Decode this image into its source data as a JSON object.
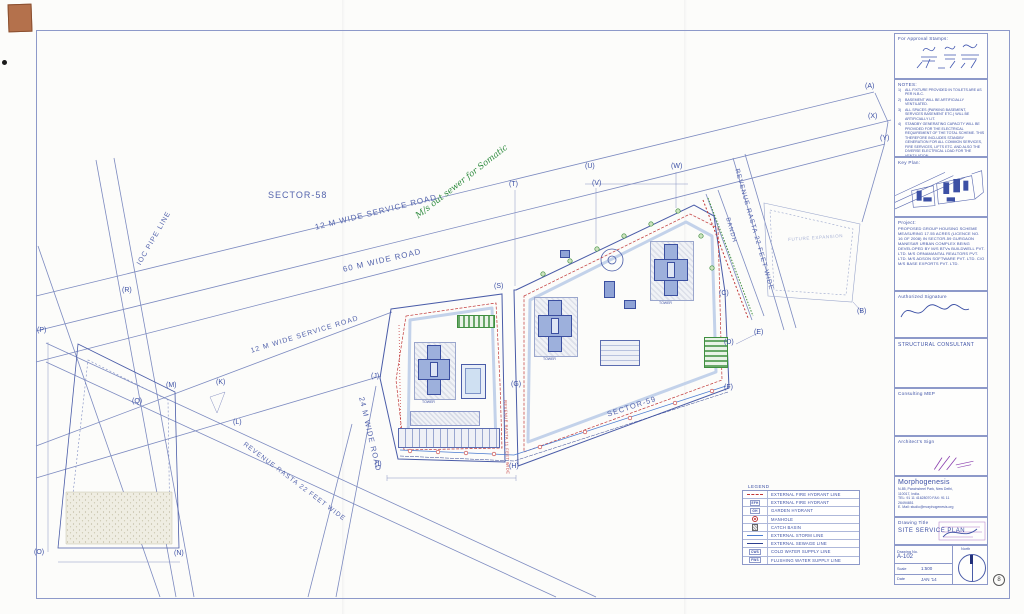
{
  "colors": {
    "line": "#7c8ac0",
    "boundary": "#4a5ca8",
    "red": "#c03636",
    "green": "#3f8f3f",
    "purple": "#8a3fae",
    "paper": "#fcfcfa"
  },
  "plan": {
    "labels": [
      {
        "text": "SECTOR-58",
        "left": 268,
        "top": 190,
        "size": 9,
        "cls": "lbl"
      },
      {
        "text": "12 M  WIDE SERVICE  ROAD",
        "left": 314,
        "top": 223,
        "rot": -14,
        "size": 8,
        "cls": "lbl"
      },
      {
        "text": "60 M  WIDE ROAD",
        "left": 342,
        "top": 265,
        "rot": -13,
        "size": 8,
        "cls": "lbl"
      },
      {
        "text": "12 M  WIDE SERVICE ROAD",
        "left": 250,
        "top": 348,
        "rot": -17,
        "size": 7,
        "cls": "lbl"
      },
      {
        "text": "24 M  WIDE  ROAD",
        "left": 366,
        "top": 396,
        "rot": 77,
        "size": 7.5,
        "cls": "lbl"
      },
      {
        "text": "IOC PIPE LINE",
        "left": 136,
        "top": 263,
        "rot": -60,
        "size": 7,
        "cls": "lbl"
      },
      {
        "text": "REVENUE RASTA 22 FEET WIDE",
        "left": 740,
        "top": 168,
        "rot": 74,
        "size": 6.5,
        "cls": "lbl"
      },
      {
        "text": "REVENUE RASTA 22 FEET WIDE",
        "left": 246,
        "top": 441,
        "rot": 37,
        "size": 6.5,
        "cls": "lbl"
      },
      {
        "text": "REVENUE RASTA 11 FEET WIDE",
        "left": 508,
        "top": 400,
        "rot": 88,
        "size": 4,
        "cls": "lbl-red"
      },
      {
        "text": "SECTOR-59",
        "left": 606,
        "top": 410,
        "rot": -18,
        "size": 7.5,
        "cls": "lbl"
      },
      {
        "text": "BANDH",
        "left": 730,
        "top": 217,
        "rot": 74,
        "size": 6,
        "cls": "lbl"
      },
      {
        "text": "FUTURE EXPANSION",
        "left": 788,
        "top": 237,
        "rot": -4,
        "size": 4.5,
        "cls": "lbl-faint"
      },
      {
        "text": "M/s out sewer for Somatic",
        "left": 414,
        "top": 213,
        "rot": -38,
        "size": 8.5,
        "cls": "green-note"
      }
    ],
    "markers": [
      {
        "text": "(A)",
        "left": 865,
        "top": 83
      },
      {
        "text": "(X)",
        "left": 868,
        "top": 113
      },
      {
        "text": "(Y)",
        "left": 880,
        "top": 135
      },
      {
        "text": "(U)",
        "left": 585,
        "top": 163
      },
      {
        "text": "(V)",
        "left": 592,
        "top": 180
      },
      {
        "text": "(W)",
        "left": 671,
        "top": 163
      },
      {
        "text": "(T)",
        "left": 509,
        "top": 181
      },
      {
        "text": "(S)",
        "left": 494,
        "top": 283
      },
      {
        "text": "(B)",
        "left": 857,
        "top": 308
      },
      {
        "text": "(C)",
        "left": 719,
        "top": 290
      },
      {
        "text": "(E)",
        "left": 754,
        "top": 329
      },
      {
        "text": "(D)",
        "left": 724,
        "top": 339
      },
      {
        "text": "(F)",
        "left": 724,
        "top": 384
      },
      {
        "text": "(G)",
        "left": 511,
        "top": 381
      },
      {
        "text": "(H)",
        "left": 509,
        "top": 463
      },
      {
        "text": "(I)",
        "left": 375,
        "top": 461
      },
      {
        "text": "(J)",
        "left": 371,
        "top": 373
      },
      {
        "text": "(K)",
        "left": 216,
        "top": 379
      },
      {
        "text": "(L)",
        "left": 233,
        "top": 419
      },
      {
        "text": "(M)",
        "left": 166,
        "top": 382
      },
      {
        "text": "(Q)",
        "left": 132,
        "top": 398
      },
      {
        "text": "(P)",
        "left": 37,
        "top": 327
      },
      {
        "text": "(R)",
        "left": 122,
        "top": 287
      },
      {
        "text": "(O)",
        "left": 34,
        "top": 549
      },
      {
        "text": "(N)",
        "left": 174,
        "top": 550
      }
    ],
    "tower_labels": [
      {
        "text": "TOWER",
        "left": 422,
        "top": 400
      },
      {
        "text": "TOWER",
        "left": 543,
        "top": 357
      },
      {
        "text": "TOWER",
        "left": 659,
        "top": 301
      }
    ]
  },
  "legend": {
    "title": "LEGEND",
    "items": [
      {
        "sym": "fireline",
        "label": "EXTERNAL FIRE HYDRANT LINE"
      },
      {
        "sym": "efh",
        "tag": "EFH",
        "label": "EXTERNAL FIRE HYDRANT"
      },
      {
        "sym": "gh",
        "tag": "GH",
        "label": "GARDEN HYDRANT"
      },
      {
        "sym": "manhole",
        "label": "MANHOLE"
      },
      {
        "sym": "catch",
        "label": "CATCH BASIN"
      },
      {
        "sym": "storm",
        "label": "EXTERNAL STORM LINE"
      },
      {
        "sym": "sewage",
        "label": "EXTERNAL SEWAGE LINE"
      },
      {
        "sym": "cws",
        "tag": "CWS",
        "label": "COLD WATER SUPPLY LINE"
      },
      {
        "sym": "fws",
        "tag": "FWS",
        "label": "FLUSHING WATER SUPPLY LINE"
      }
    ]
  },
  "titleblock": {
    "approval_label": "For Approval Stamps:",
    "notes_title": "NOTES:",
    "notes": [
      {
        "n": "1)",
        "t": "ALL FIXTURE PROVIDED IN TOILETS ARE AS PER N.B.C."
      },
      {
        "n": "2)",
        "t": "BASEMENT WILL BE ARTIFICIALLY VENTILATED."
      },
      {
        "n": "3)",
        "t": "ALL SPACES (PARKING BASEMENT, SERVICES BASEMENT ETC.) WILL BE ARTIFICIALLY LIT."
      },
      {
        "n": "4)",
        "t": "STANDBY GENERATING CAPACITY WILL BE PROVIDED FOR THE ELECTRICAL REQUIREMENT OF THE TOTAL SCHEME. THIS THEREFORE INCLUDES STANDBY GENERATION FOR ALL COMMON SERVICES, FIRE SERVICES, LIFTS ETC. AND ALSO THE DIVERSE ELECTRICAL LOAD FOR THE VENTILATION."
      },
      {
        "n": "5)",
        "t": "FIRE SAFETY MEASURES AS PER NBC INCLUDES SMOKE DETECTOR, HEAT DETECTOR, SPRINKLER SPACING IN COMPLIANCE WITH CODE."
      }
    ],
    "keyplan_label": "Key Plan:",
    "project_label": "Project:",
    "project_text": "PROPOSED GROUP HOUSING SCHEME MEASURING 17.55 ACRES (LICENCE NO. 16 OF 2008) IN SECTOR-59 GURGAON MANESAR URBAN COMPLEX BEING DEVELOPED BY M/S BTVs BUILDWELL PVT. LTD. M/S ORNAMANTAL REALTORS PVT. LTD. M/S ADSON SOFTWARE PVT. LTD. C/O M/S BASE EXPORTS PVT. LTD.",
    "authorized_label": "Authorized  Signature",
    "structural_label": "STRUCTURAL  CONSULTANT",
    "mep_label": "Consulting  MEP",
    "architect_label": "Architect's  Sign",
    "firm_name": "Morphogenesis",
    "address": [
      "N-85, Panchsheel Park, New Delhi,",
      "110017, India.",
      "TEL: 91 11 41628070   FAX: 91 11",
      "26494651",
      "E. Mail: studio@morphogenesis.org"
    ],
    "drawing_title_label": "Drawing  Title",
    "drawing_title": "SITE  SERVICE  PLAN",
    "drawing_no_label": "Drawing  No.",
    "drawing_no": "A-102",
    "scale_label": "Scale",
    "scale": "1:500",
    "date_label": "Date",
    "date": "JAN '14",
    "north_label": "North",
    "sheet_mark": "8"
  }
}
